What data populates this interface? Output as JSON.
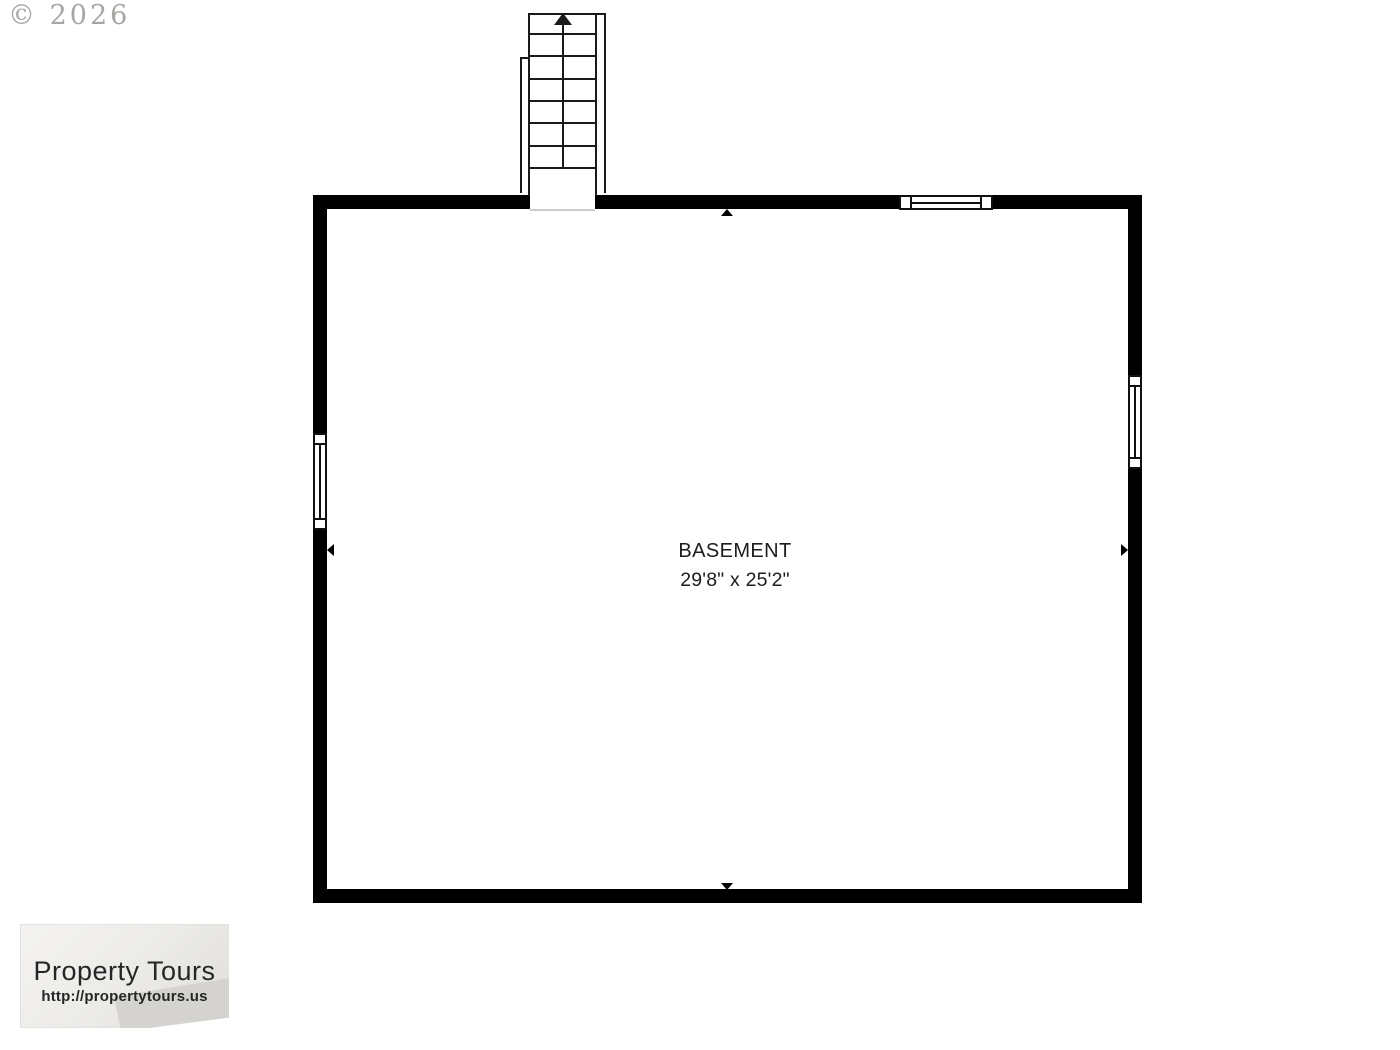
{
  "watermark": {
    "text": "© 2026"
  },
  "floor_plan": {
    "room": {
      "name": "BASEMENT",
      "dimensions": "29'8\" x 25'2\""
    },
    "colors": {
      "wall": "#000000",
      "line": "#1a1a1a",
      "watermark_gray": "#a2a29e",
      "threshold_gray": "#cccccc"
    },
    "icons": {
      "stairs": "staircase-with-up-arrow",
      "marker_top": "up-triangle",
      "marker_bottom": "down-triangle",
      "marker_left": "left-triangle",
      "marker_right": "right-triangle",
      "window_top_wall": "window-glyph",
      "window_left_wall": "window-glyph",
      "window_right_wall": "window-glyph"
    }
  },
  "logo": {
    "title": "Property Tours",
    "url": "http://propertytours.us"
  }
}
